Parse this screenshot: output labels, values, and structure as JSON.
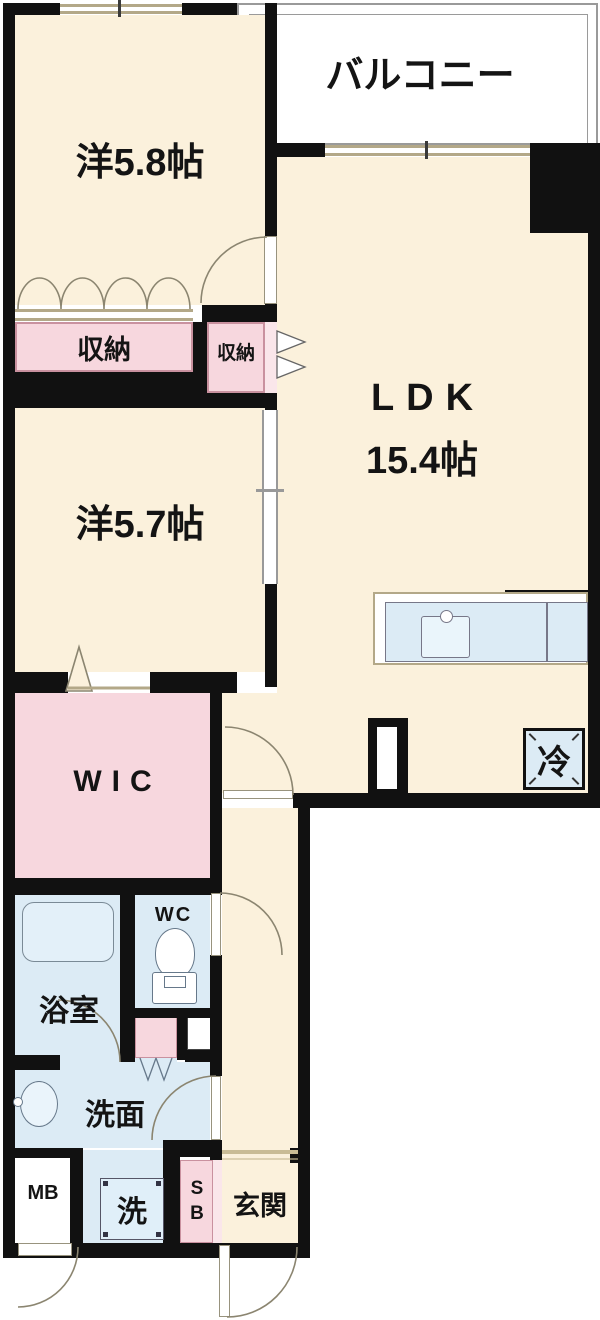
{
  "floorplan": {
    "balcony": {
      "label": "バルコニー"
    },
    "rooms": {
      "bedroom1": {
        "label": "洋5.8帖"
      },
      "ldk": {
        "label": "LDK",
        "size": "15.4帖"
      },
      "bedroom2": {
        "label": "洋5.7帖"
      },
      "wic": {
        "label": "WIC"
      },
      "storage_left": {
        "label": "収納"
      },
      "storage_right": {
        "label": "収納"
      },
      "bathroom": {
        "label": "浴室"
      },
      "toilet": {
        "label": "WC"
      },
      "washroom": {
        "label": "洗面"
      },
      "entrance": {
        "label": "玄関"
      },
      "meter_box": {
        "label": "MB"
      },
      "shoe_box": {
        "label": "SB"
      },
      "washer": {
        "label": "洗"
      },
      "refrigerator": {
        "label": "冷"
      }
    },
    "colors": {
      "wall": "#111111",
      "room_cream": "#FBF1DC",
      "closet_pink": "#F7D7DE",
      "closet_pink_light": "#FAE6EA",
      "water_blue": "#DCEBF5",
      "window_tan": "#B3A888",
      "balcony_outline": "#9A9A9A"
    }
  }
}
